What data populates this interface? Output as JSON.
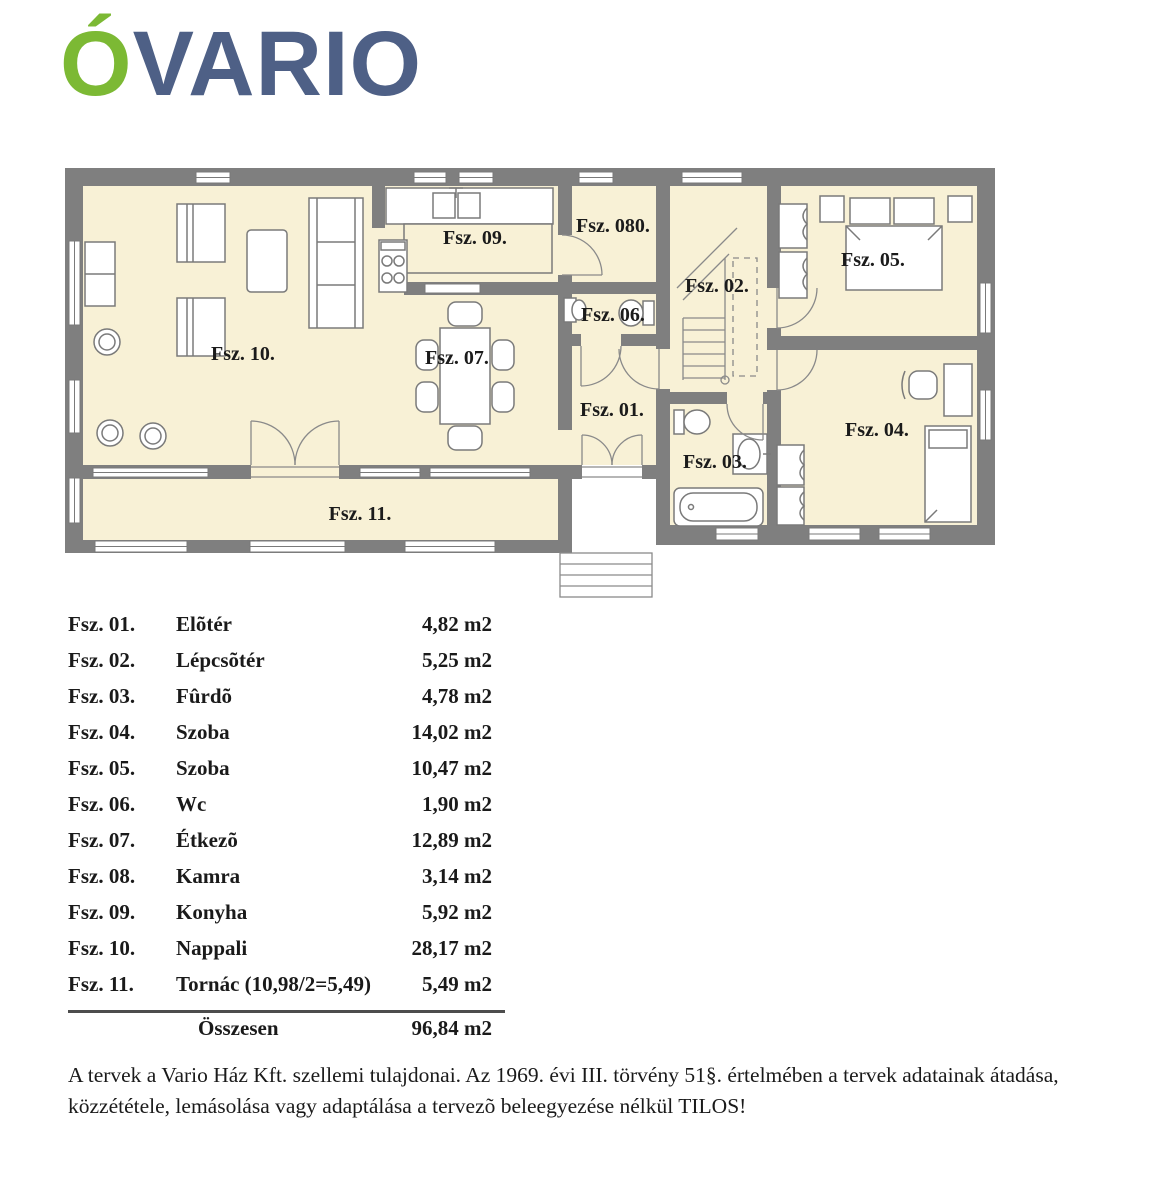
{
  "logo": {
    "accent": "Ó",
    "name": "VARIO",
    "accent_color": "#7cb934",
    "name_color": "#4e6086"
  },
  "plan": {
    "colors": {
      "wall": "#7f7f7f",
      "floor": "#f8f1d6",
      "furniture_outline": "#7a7a7a"
    },
    "labels": {
      "fsz01": "Fsz. 01.",
      "fsz02": "Fsz. 02.",
      "fsz03": "Fsz. 03.",
      "fsz04": "Fsz. 04.",
      "fsz05": "Fsz. 05.",
      "fsz06": "Fsz. 06.",
      "fsz080": "Fsz. 080.",
      "fsz07": "Fsz. 07.",
      "fsz09": "Fsz. 09.",
      "fsz10": "Fsz. 10.",
      "fsz11": "Fsz. 11."
    }
  },
  "table": {
    "rows": [
      {
        "code": "Fsz. 01.",
        "name": "Elõtér",
        "area": "4,82 m2"
      },
      {
        "code": "Fsz. 02.",
        "name": "Lépcsõtér",
        "area": "5,25 m2"
      },
      {
        "code": "Fsz. 03.",
        "name": "Fûrdõ",
        "area": "4,78 m2"
      },
      {
        "code": "Fsz. 04.",
        "name": "Szoba",
        "area": "14,02 m2"
      },
      {
        "code": "Fsz. 05.",
        "name": "Szoba",
        "area": "10,47 m2"
      },
      {
        "code": "Fsz. 06.",
        "name": "Wc",
        "area": "1,90 m2"
      },
      {
        "code": "Fsz. 07.",
        "name": "Étkezõ",
        "area": "12,89 m2"
      },
      {
        "code": "Fsz. 08.",
        "name": "Kamra",
        "area": "3,14 m2"
      },
      {
        "code": "Fsz. 09.",
        "name": "Konyha",
        "area": "5,92 m2"
      },
      {
        "code": "Fsz. 10.",
        "name": "Nappali",
        "area": "28,17 m2"
      },
      {
        "code": "Fsz. 11.",
        "name": "Tornác (10,98/2=5,49)",
        "area": "5,49 m2"
      }
    ],
    "total": {
      "label": "Összesen",
      "area": "96,84 m2"
    }
  },
  "disclaimer": "A tervek a Vario Ház Kft. szellemi tulajdonai. Az 1969. évi III. törvény 51§. értelmében a tervek adatainak átadása, közzététele, lemásolása vagy adaptálása a tervezõ beleegyezése nélkül TILOS!"
}
